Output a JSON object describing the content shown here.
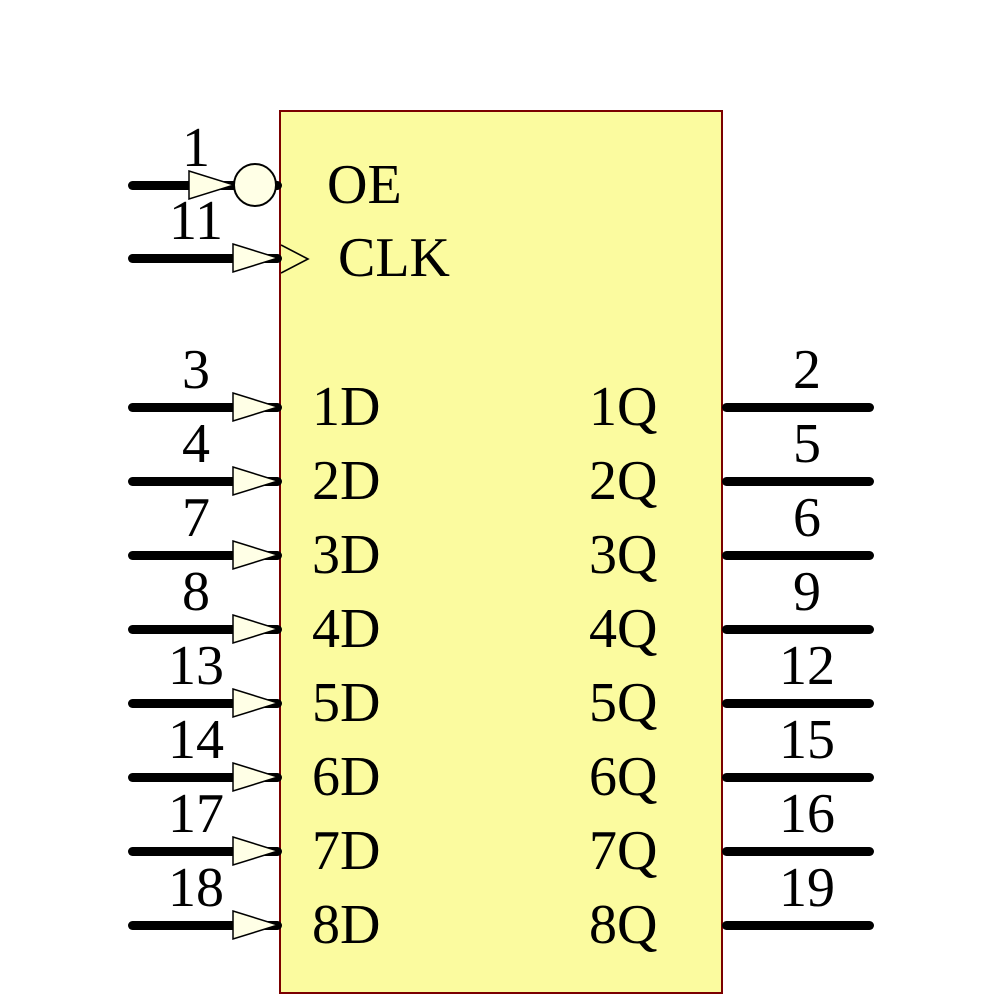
{
  "component": {
    "kind": "ic-schematic-symbol",
    "control_pins": [
      {
        "pin": "1",
        "label": "OE",
        "decoration": "inversion-bubble",
        "side": "left"
      },
      {
        "pin": "11",
        "label": "CLK",
        "decoration": "clock-edge-chevron",
        "side": "left"
      }
    ],
    "input_pins": [
      {
        "pin": "3",
        "label": "1D"
      },
      {
        "pin": "4",
        "label": "2D"
      },
      {
        "pin": "7",
        "label": "3D"
      },
      {
        "pin": "8",
        "label": "4D"
      },
      {
        "pin": "13",
        "label": "5D"
      },
      {
        "pin": "14",
        "label": "6D"
      },
      {
        "pin": "17",
        "label": "7D"
      },
      {
        "pin": "18",
        "label": "8D"
      }
    ],
    "output_pins": [
      {
        "pin": "2",
        "label": "1Q"
      },
      {
        "pin": "5",
        "label": "2Q"
      },
      {
        "pin": "6",
        "label": "3Q"
      },
      {
        "pin": "9",
        "label": "4Q"
      },
      {
        "pin": "12",
        "label": "5Q"
      },
      {
        "pin": "15",
        "label": "6Q"
      },
      {
        "pin": "16",
        "label": "7Q"
      },
      {
        "pin": "19",
        "label": "8Q"
      }
    ],
    "colors": {
      "body_fill": "#FBFB9F",
      "body_border": "#7B0000",
      "pin_wire": "#000000",
      "arrow_fill": "#FFFFE6",
      "background": "#FFFFFF"
    }
  }
}
